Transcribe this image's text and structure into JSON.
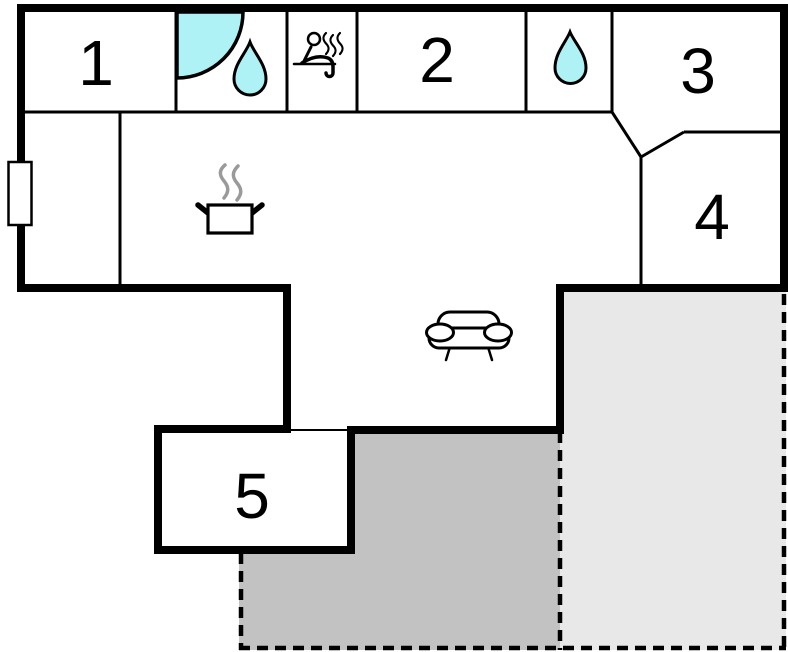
{
  "plan": {
    "type": "floor-plan",
    "rooms": [
      {
        "label": "1"
      },
      {
        "label": "2"
      },
      {
        "label": "3"
      },
      {
        "label": "4"
      },
      {
        "label": "5"
      }
    ],
    "icons": [
      "shower-icon",
      "water-drop-icon",
      "sauna-icon",
      "water-drop-icon",
      "cooking-pot-icon",
      "sofa-icon",
      "window"
    ],
    "areas": [
      {
        "name": "terrace-covered",
        "border": "dashed"
      },
      {
        "name": "terrace-open",
        "border": "dashed"
      }
    ],
    "colors": {
      "background": "#ffffff",
      "wall": "#000000",
      "water": "#aef2f6",
      "terrace_dark": "#c2c2c2",
      "terrace_light": "#e8e8e8",
      "steam": "#9a9a9a"
    }
  }
}
